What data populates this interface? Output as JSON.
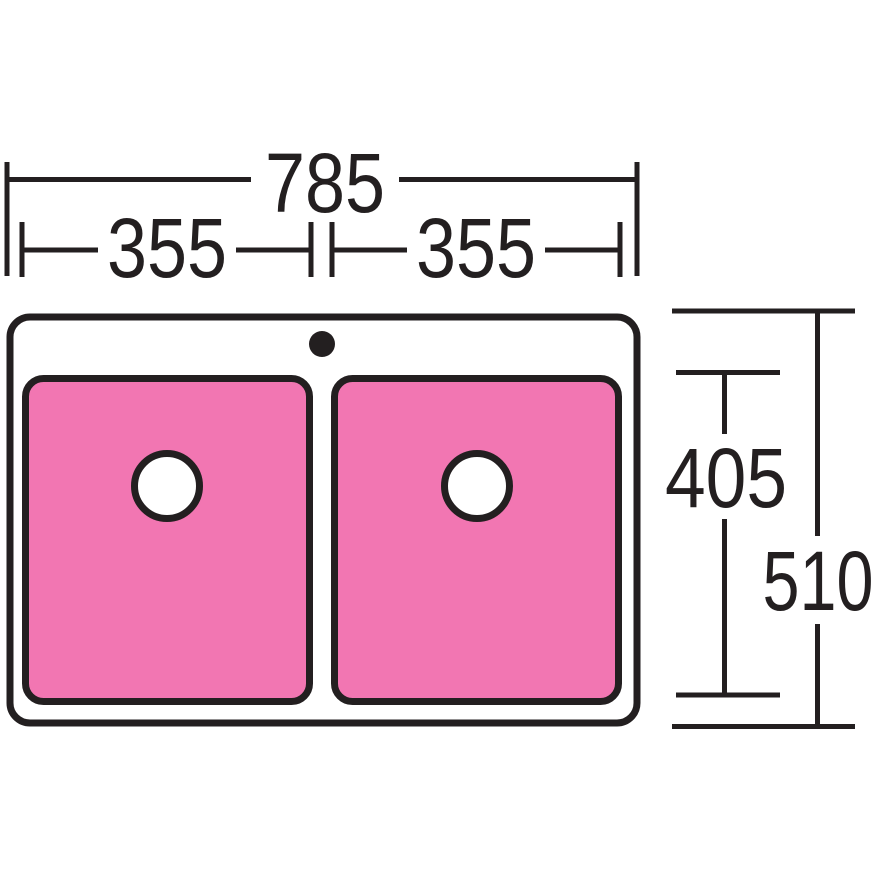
{
  "diagram": {
    "colors": {
      "ink": "#231F20",
      "bowl_fill": "#F276B2",
      "surface_fill": "#FFFFFF"
    },
    "dimensions": {
      "overall_width": "785",
      "left_bowl_width": "355",
      "right_bowl_width": "355",
      "bowl_front_to_back": "405",
      "overall_front_to_back": "510"
    }
  }
}
